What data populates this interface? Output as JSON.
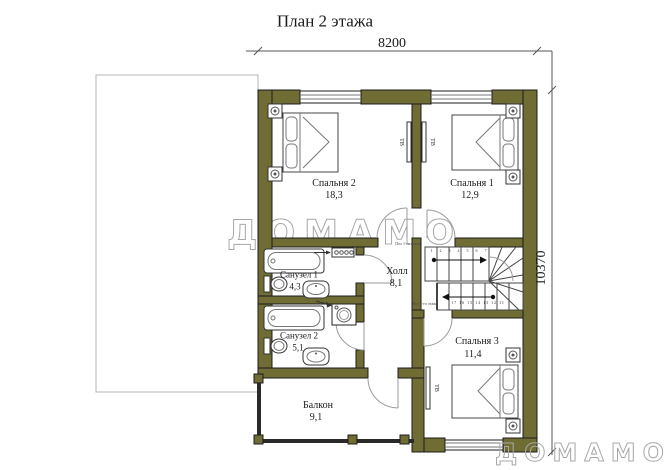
{
  "title": "План 2 этажа",
  "dimensions": {
    "width_label": "8200",
    "height_label": "10370"
  },
  "watermark": {
    "center": "ДОМАМО",
    "corner": "ДОМАМО"
  },
  "rooms": {
    "bedroom2": {
      "name": "Спальня 2",
      "area": "18,3"
    },
    "bedroom1": {
      "name": "Спальня 1",
      "area": "12,9"
    },
    "bedroom3": {
      "name": "Спальня 3",
      "area": "11,4"
    },
    "bathroom1": {
      "name": "Санузел 1",
      "area": "4,3"
    },
    "bathroom2": {
      "name": "Санузел 2",
      "area": "5,1"
    },
    "hall": {
      "name": "Холл",
      "area": "8,1"
    },
    "balcony": {
      "name": "Балкон",
      "area": "9,1"
    }
  },
  "labels": {
    "tv": "ТВ",
    "floor1": "Пол 1-го этажа",
    "floor2": "Пол 2-го этажа",
    "stairs_top_numbers": "1 2 3 4 5 6 7",
    "stairs_bottom_numbers": "17 16 15 14 13 12 11"
  },
  "colors": {
    "wall": "#6f6d34",
    "outline": "#1c1c1c",
    "thin": "#8a8a8a",
    "wm": "#a8a8a8"
  }
}
